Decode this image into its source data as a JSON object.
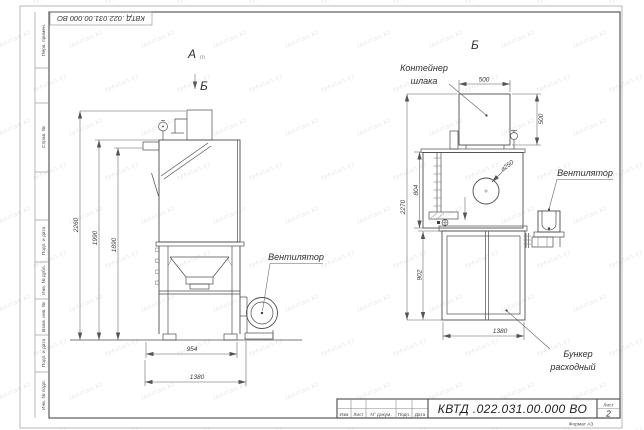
{
  "watermark": {
    "text": "tehstan.kz"
  },
  "colors": {
    "line": "#4e4e4e",
    "dim_line": "#5e5e5e",
    "text": "#2e2e2e",
    "watermark": "#8ea0b0"
  },
  "frame": {
    "top_stamp": "КВТД .022.031.00.000 ВО",
    "side_labels": [
      "Перв. примен.",
      "Справ. №",
      "Подп. и дата",
      "Инв. № дубл.",
      "Взам. инв. №",
      "Подп. и дата",
      "Инв. № подл."
    ]
  },
  "title_block": {
    "doc_number": "КВТД .022.031.00.000 ВО",
    "columns": [
      "Изм",
      "Лист",
      "N° докум.",
      "Подп.",
      "Дата"
    ],
    "sheet_label": "Лист",
    "sheet_number": "2",
    "format": "Формат А3"
  },
  "left_view": {
    "view_label": "А",
    "view_label_sub": "т",
    "direction_marker": "Б",
    "fan_label": "Вентилятор",
    "dim_total_height": "2260",
    "dim_hood_height": "1990",
    "dim_ledge_height": "1890",
    "dim_frame_width": "954",
    "dim_overall_width": "1380"
  },
  "right_view": {
    "view_label": "Б",
    "container_label_line1": "Контейнер",
    "container_label_line2": "шлака",
    "fan_label": "Вентилятор",
    "bunker_label_line1": "Бункер",
    "bunker_label_line2": "расходный",
    "dim_container_width": "500",
    "dim_container_height": "500",
    "dim_body_height": "804",
    "dim_total_height": "2270",
    "dim_bunker_height": "902",
    "dim_bunker_width": "1380",
    "dim_hole_diameter": "⌀250"
  }
}
